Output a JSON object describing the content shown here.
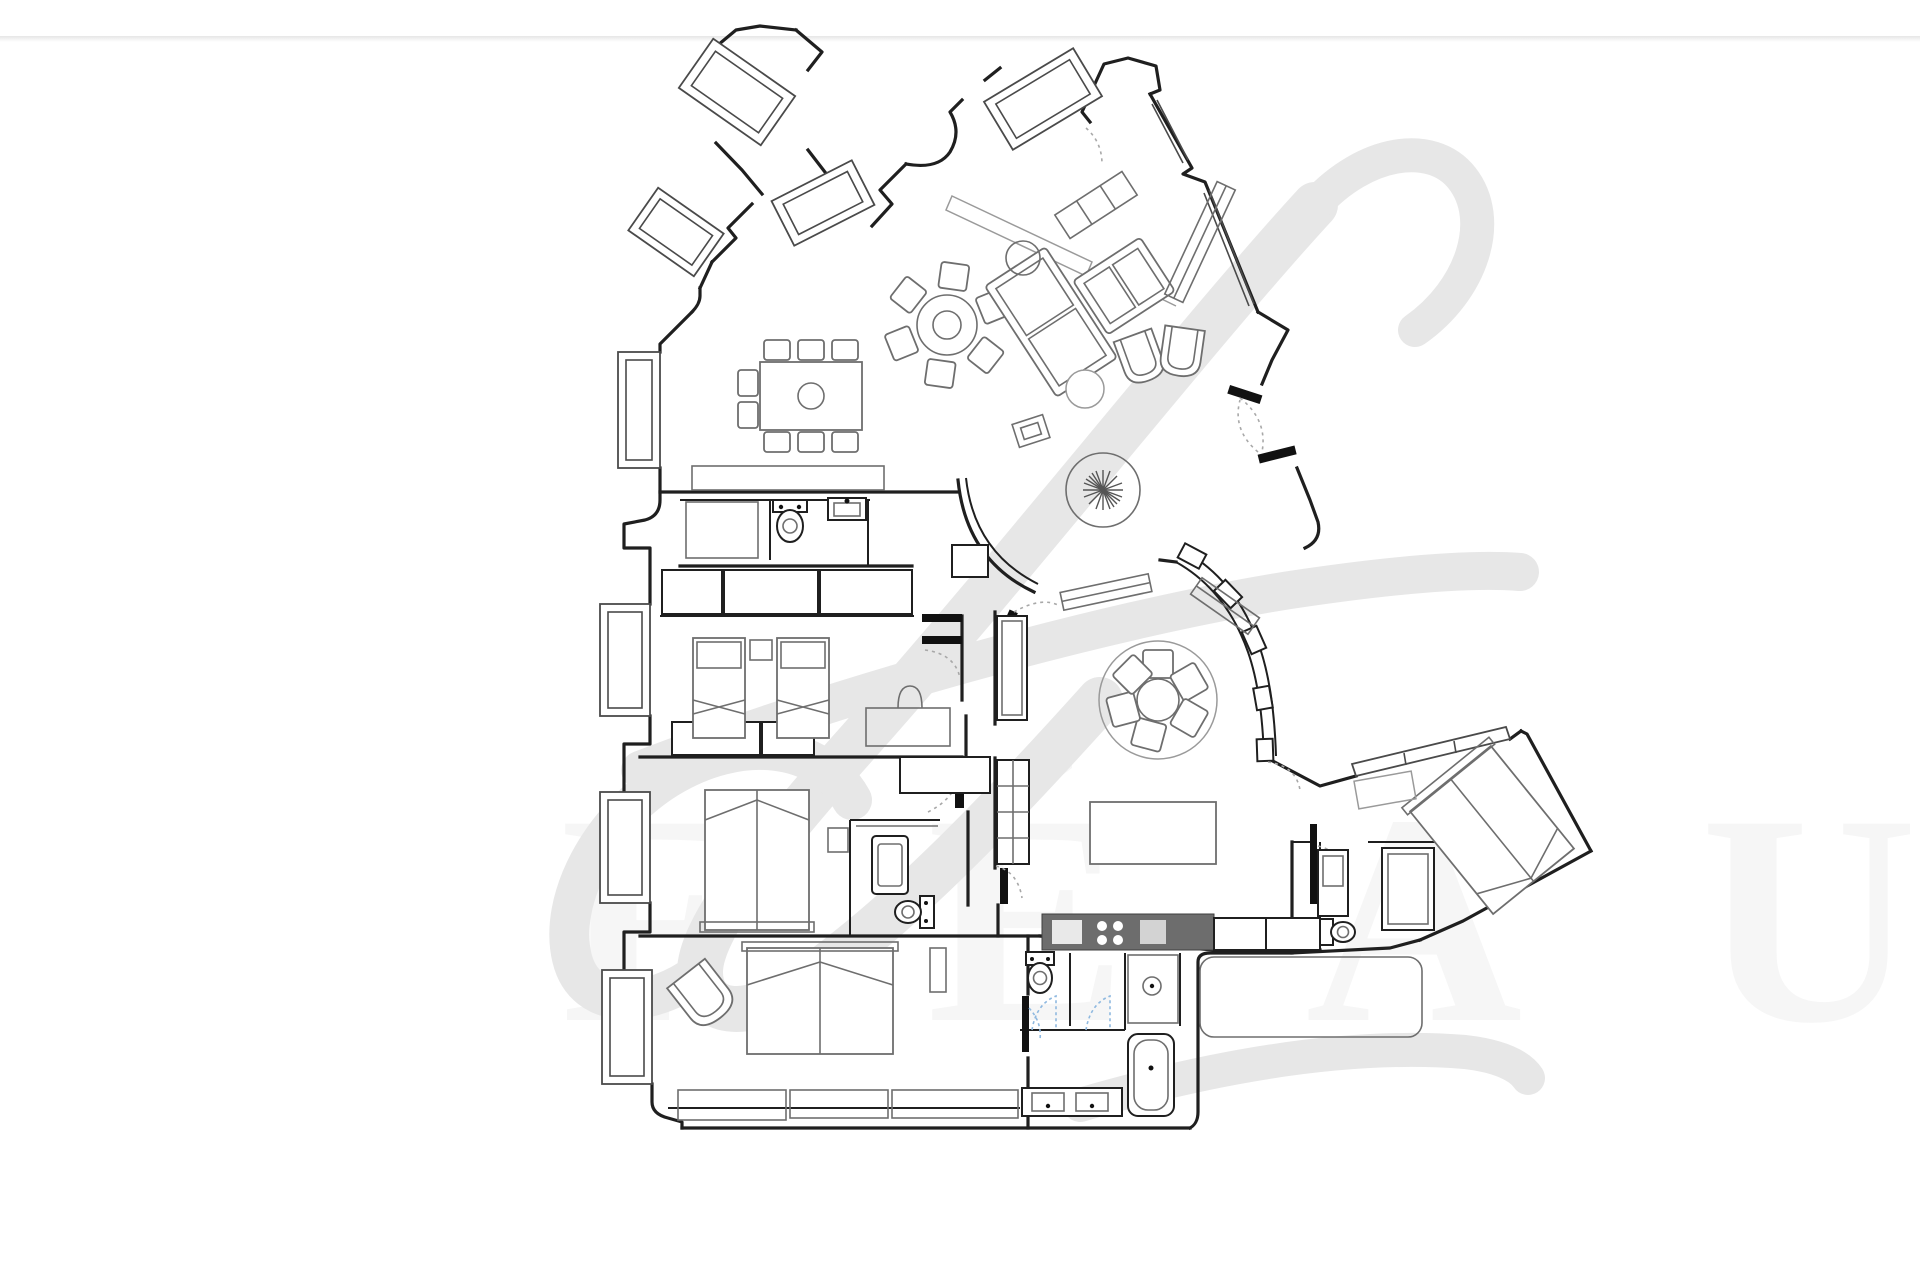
{
  "document": {
    "kind": "real-estate floor plan",
    "visible_text": "none (drawing only)",
    "page_background": "#ffffff"
  },
  "colors": {
    "bg": "#ffffff",
    "wall": "#1f1f1f",
    "furn": "#6e6e6e",
    "furnlight": "#9a9a9a",
    "win": "#4a4a4a",
    "arc": "#a8a8a8",
    "bluearc": "#8fb9e0",
    "appl": "#6d6d6d",
    "wm": "#e7e7e7",
    "wmtext": "#efefef",
    "divider": "#e2e2e2"
  },
  "watermark": {
    "glyph": "f",
    "letters": "F É A U",
    "note": "large pale script monogram swoosh + very faint oversized letter row behind plan"
  },
  "fixtures": [
    "dining-table",
    "dining-chair",
    "round-pedestal-table",
    "sofa",
    "tub-armchair",
    "side-table",
    "plant",
    "twin-bed",
    "double-bed",
    "wardrobe",
    "toilet",
    "bidet",
    "washbasin",
    "bathtub",
    "shower",
    "kitchen-counter",
    "kitchen-island",
    "round-dining-nook-table",
    "rug",
    "bench",
    "radiator",
    "bay-window",
    "door-leaf",
    "door-swing"
  ]
}
